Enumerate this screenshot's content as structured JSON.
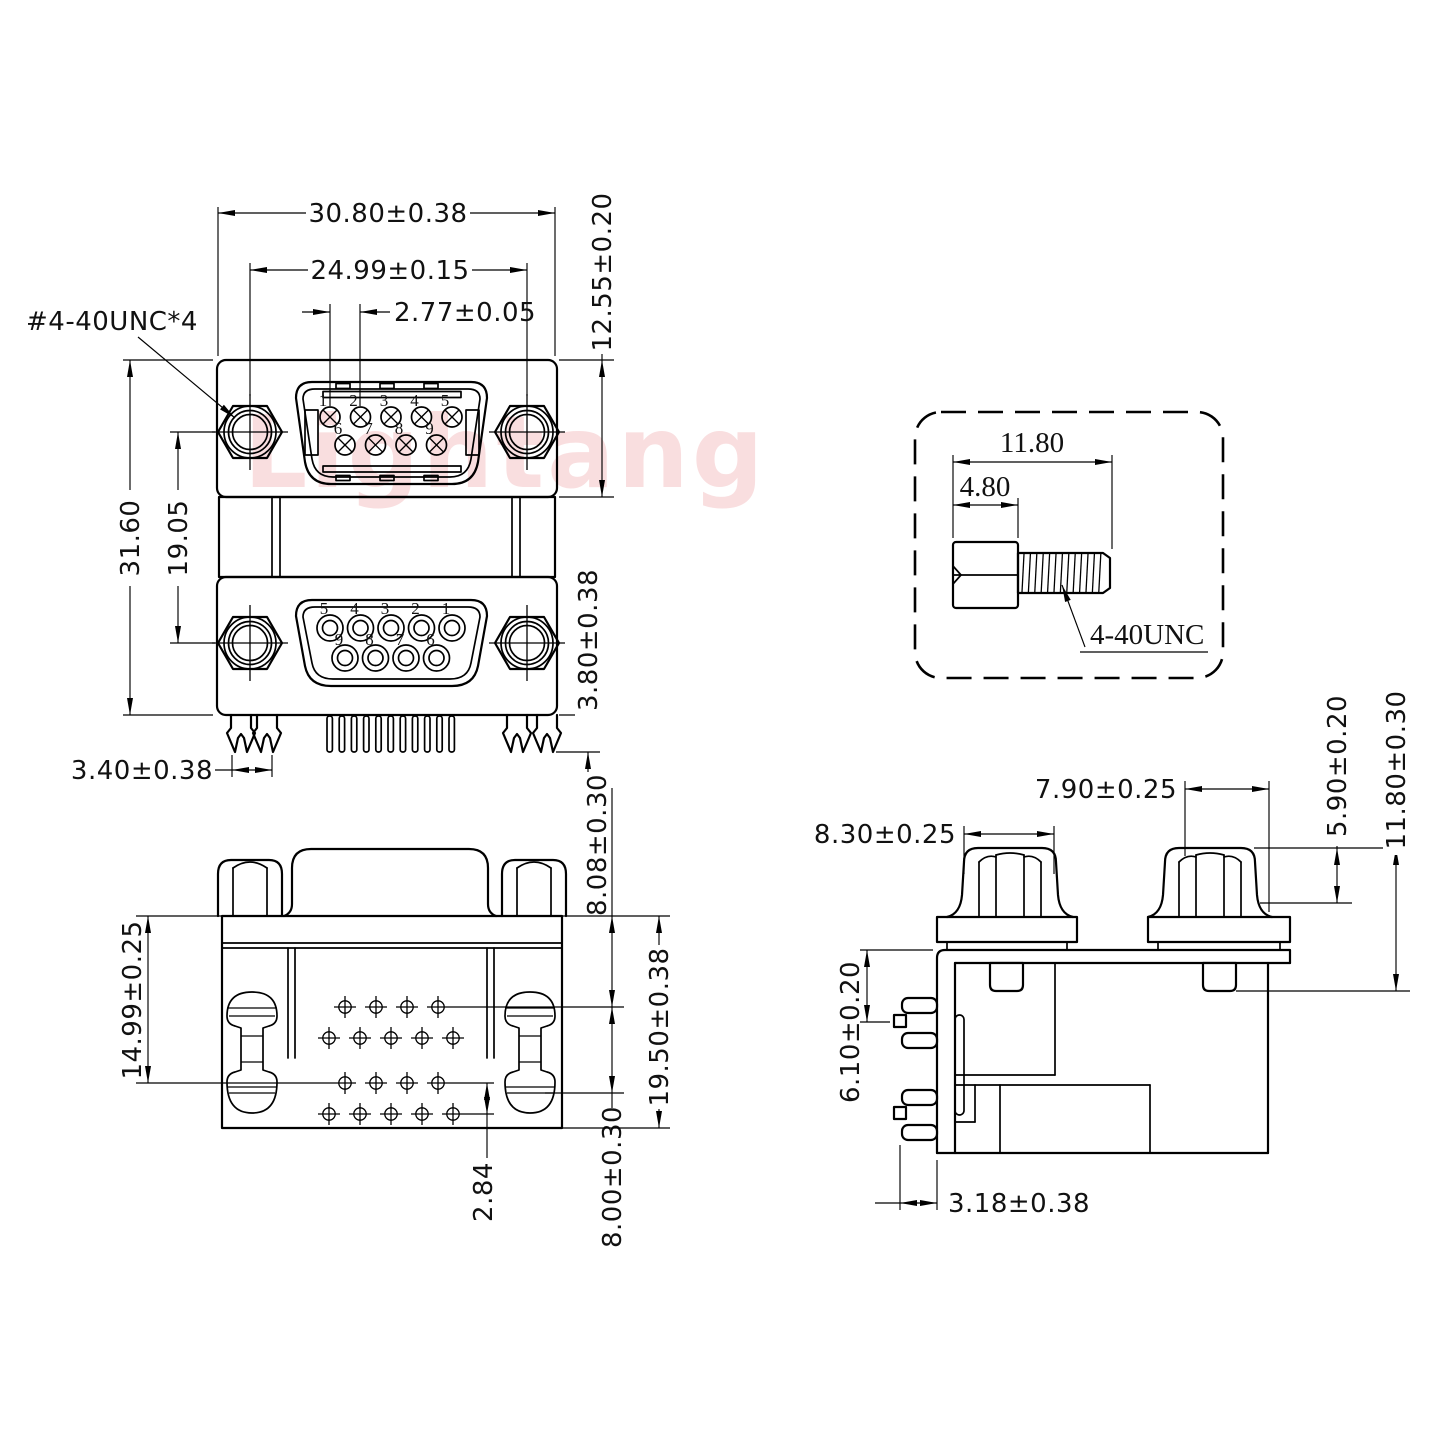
{
  "colors": {
    "line": "#000000",
    "watermark": "#f2b7ba",
    "background": "#ffffff"
  },
  "watermark_text": "Lightang",
  "front_view": {
    "dims": {
      "overall_width": "30.80±0.38",
      "mount_hole_spacing": "24.99±0.15",
      "pin_pitch": "2.77±0.05",
      "screw_thread_callout": "#4-40UNC*4",
      "upper_port_height": "12.55±0.20",
      "overall_height": "31.60",
      "port_center_spacing": "19.05",
      "pin_protrusion": "3.80±0.38",
      "leg_tip_width": "3.40±0.38"
    },
    "upper_port_pin_numbers": {
      "row1": [
        "1",
        "2",
        "3",
        "4",
        "5"
      ],
      "row2": [
        "6",
        "7",
        "8",
        "9"
      ]
    },
    "lower_port_pin_numbers": {
      "row1": [
        "5",
        "4",
        "3",
        "2",
        "1"
      ],
      "row2": [
        "9",
        "8",
        "7",
        "6"
      ]
    }
  },
  "screw_detail": {
    "dims": {
      "overall_length": "11.80",
      "head_length": "4.80"
    },
    "thread_callout": "4-40UNC"
  },
  "bottom_view": {
    "dims": {
      "edge_to_row_offset": "14.99±0.25",
      "top_edge_to_first_row": "8.08±0.30",
      "overall_depth": "19.50±0.38",
      "first_row_span": "8.00±0.30",
      "pin_row_pitch": "2.84"
    }
  },
  "side_view": {
    "dims": {
      "left_standoff_width": "8.30±0.25",
      "right_standoff_width": "7.90±0.25",
      "standoff_nut_height": "5.90±0.20",
      "standoff_overall_height": "11.80±0.30",
      "plate_to_pin_row": "6.10±0.20",
      "pin_tip_setback": "3.18±0.38"
    }
  }
}
